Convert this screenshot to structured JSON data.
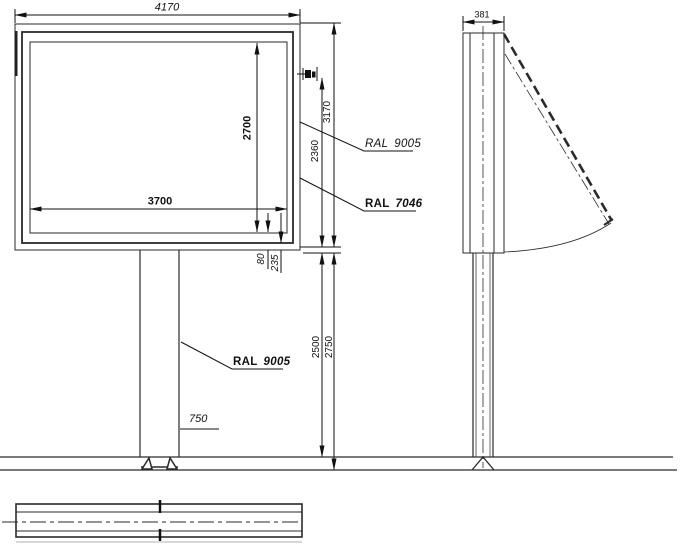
{
  "dimensions": {
    "front_width": "4170",
    "panel_width": "3700",
    "panel_height": "2700",
    "box_height": "3170",
    "face_height": "2360",
    "clearance_height": "2500",
    "total_clearance": "2750",
    "edge_offset": "80",
    "frame_offset": "235",
    "pole_width": "750",
    "side_depth": "381"
  },
  "labels": {
    "ral_top": {
      "prefix": "RAL",
      "value": "9005"
    },
    "ral_mid": {
      "prefix": "RAL",
      "value": "7046"
    },
    "ral_pole": {
      "prefix": "RAL",
      "value": "9005"
    }
  },
  "colors": {
    "line": "#2a2a2a",
    "background": "#ffffff"
  }
}
